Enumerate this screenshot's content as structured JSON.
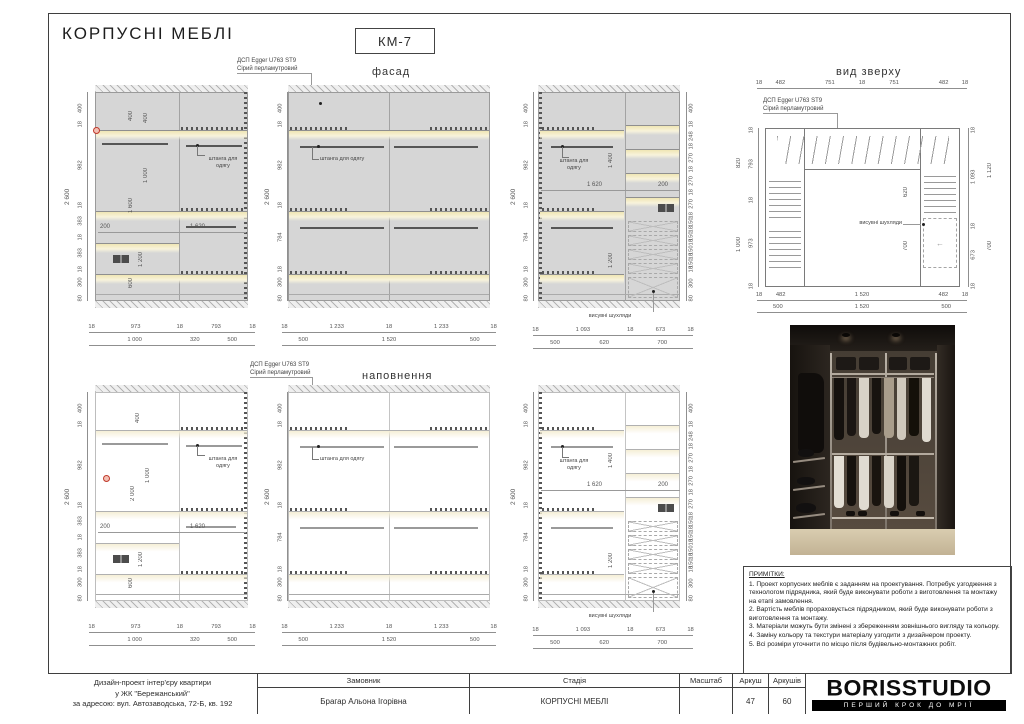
{
  "sheet": {
    "title": "КОРПУСНІ МЕБЛІ",
    "code": "КМ-7"
  },
  "views": {
    "facade": "фасад",
    "filling": "наповнення",
    "top": "вид зверху"
  },
  "material": {
    "line1": "ДСП Egger U763 ST9",
    "line2": "Сірий перламутровий"
  },
  "labels": {
    "rod_line1": "штанга для",
    "rod_line2": "одягу",
    "rod_single": "штанга для одягу",
    "drawers": "висувні шухляди",
    "total_height": "2 600"
  },
  "chains": {
    "e1_left": [
      "400",
      "18",
      "982",
      "18",
      "383",
      "18",
      "383",
      "18",
      "300",
      "80"
    ],
    "e2_left": [
      "400",
      "18",
      "982",
      "18",
      "784",
      "18",
      "300",
      "80"
    ],
    "e3_left": [
      "400",
      "18",
      "982",
      "18",
      "784",
      "18",
      "300",
      "80"
    ],
    "e3_right": [
      "400",
      "18",
      "248",
      "18",
      "270",
      "18",
      "270",
      "18",
      "270",
      "18",
      "150",
      "18",
      "150",
      "18",
      "150",
      "18",
      "150",
      "18",
      "300",
      "80"
    ],
    "e1_b1": [
      "18",
      "973",
      "18",
      "793",
      "18"
    ],
    "e1_b2": [
      "1 000",
      "320",
      "500"
    ],
    "e2_b1": [
      "18",
      "1 233",
      "18",
      "1 233",
      "18"
    ],
    "e2_b2": [
      "500",
      "1 520",
      "500"
    ],
    "e3_b1": [
      "18",
      "1 093",
      "18",
      "673",
      "18"
    ],
    "e3_b2": [
      "500",
      "620",
      "700"
    ],
    "tv_top": [
      "18",
      "482",
      "751",
      "18",
      "751",
      "482",
      "18"
    ],
    "tv_left": [
      "18",
      "793",
      "18",
      "973",
      "18"
    ],
    "tv_right": [
      "18",
      "1 093",
      "18",
      "673",
      "18"
    ],
    "tv_b1": [
      "18",
      "482",
      "1 520",
      "482",
      "18"
    ],
    "tv_b2": [
      "500",
      "1 520",
      "500"
    ]
  },
  "e1": {
    "d400a": "400",
    "d400b": "400",
    "d1000": "1 000",
    "d1600": "1 600",
    "d200": "200",
    "d1620": "1 620",
    "d1200": "1 200",
    "d600": "600"
  },
  "e3": {
    "d1400": "1 400",
    "d1620": "1 620",
    "d200": "200",
    "d1200": "1 200"
  },
  "e4": {
    "d400": "400",
    "d1000": "1 000",
    "d2000": "2 000",
    "d200": "200",
    "d1620": "1 620",
    "d1200": "1 200",
    "d600": "600"
  },
  "tv": {
    "d620": "620",
    "d700": "700",
    "t820": "820",
    "t1000": "1 000",
    "t1120": "1 120",
    "t700": "700",
    "arrow": "←"
  },
  "notes": {
    "title": "ПРИМІТКИ:",
    "items": [
      "1. Проект корпусних меблів є заданням на проектування. Потребує узгодження з технологом підрядника, який буде виконувати роботи з виготовлення та монтажу на етапі замовлення.",
      "2. Вартість меблів прораховується підрядником, який буде виконувати роботи з виготовлення та монтажу.",
      "3. Матеріали можуть бути змінені з збереженням зовнішнього вигляду та кольору.",
      "4. Заміну кольору та текстури матеріалу узгодити з дизайнером проекту.",
      "5. Всі розміри уточнити по місцю після будівельно-монтажних робіт."
    ]
  },
  "titleblock": {
    "project": [
      "Дизайн-проект інтер'єру квартири",
      "у ЖК \"Бережанський\"",
      "за адресою: вул. Автозаводська, 72-Б, кв. 192"
    ],
    "customer_label": "Замовник",
    "customer": "Брагар Альона Ігорівна",
    "stage_label": "Стадія",
    "stage": "КОРПУСНІ МЕБЛІ",
    "scale_label": "Масштаб",
    "scale": "",
    "sheet_label": "Аркуш",
    "sheet": "47",
    "sheets_label": "Аркушів",
    "sheets": "60",
    "logo": "BORISSTUDIO",
    "tagline": "ПЕРШИЙ КРОК ДО МРІЇ"
  },
  "colors": {
    "body_gray": "#d6d6d6",
    "led_yellow": "#f3ecc8",
    "drawing_line": "#8f8f8f",
    "logo_black": "#000000"
  }
}
